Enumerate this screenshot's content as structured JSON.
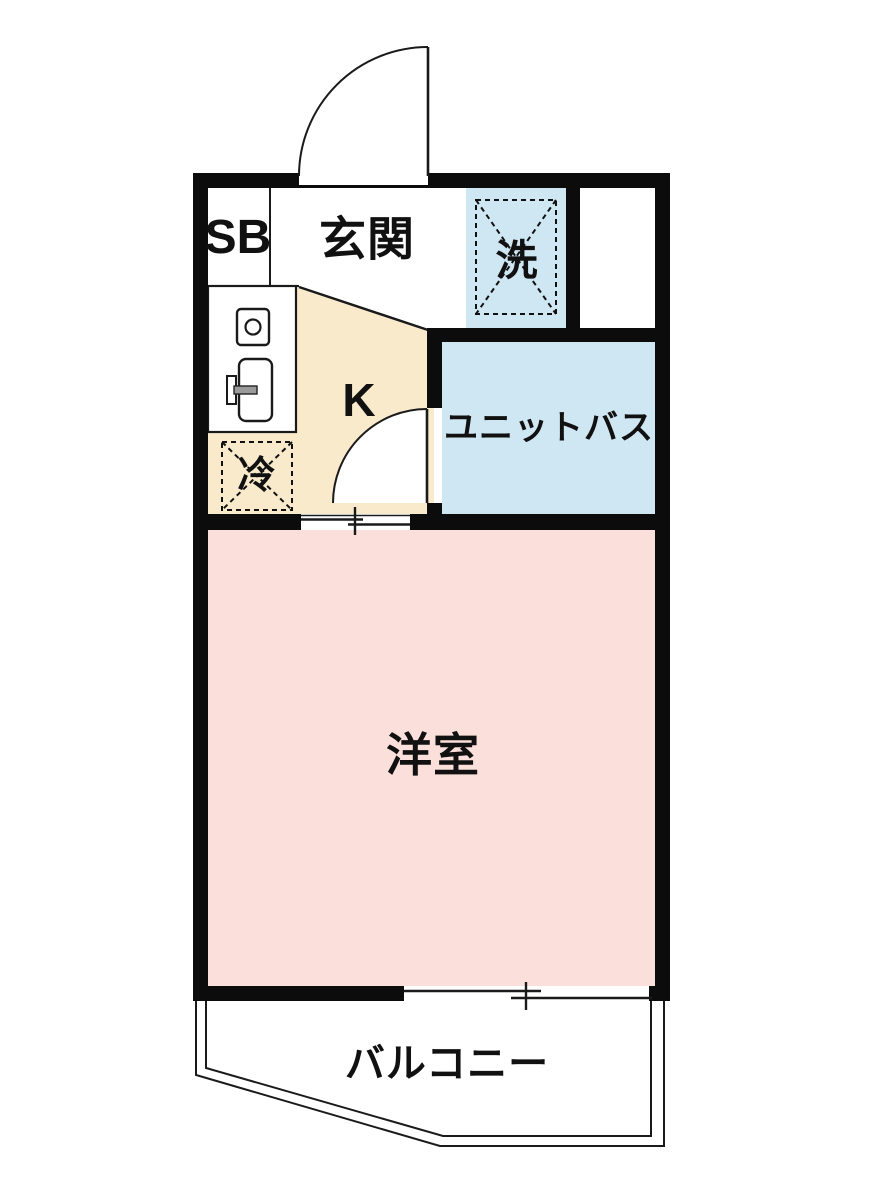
{
  "plan": {
    "rooms": {
      "shoe_box": {
        "label": "SB"
      },
      "entrance": {
        "label": "玄関"
      },
      "washer_space": {
        "label": "洗"
      },
      "kitchen": {
        "label": "K"
      },
      "unit_bath": {
        "label": "ユニットバス"
      },
      "refrigerator_space": {
        "label": "冷"
      },
      "western_room": {
        "label": "洋室"
      },
      "balcony": {
        "label": "バルコニー"
      }
    },
    "colors": {
      "wall": "#0c0c0c",
      "kitchen_fill": "#f9eacb",
      "bath_fill": "#cfe6f3",
      "washer_fill": "#cfe6f3",
      "western_room_fill": "#fbdfda",
      "background": "#ffffff",
      "line": "#1a1a1a"
    },
    "fixtures": [
      "entrance-door-swing-icon",
      "bath-door-swing-icon",
      "stove-burner-icon",
      "kitchen-sink-icon",
      "washer-placement-icon",
      "refrigerator-placement-icon",
      "sliding-door-icon",
      "sliding-window-icon"
    ]
  }
}
